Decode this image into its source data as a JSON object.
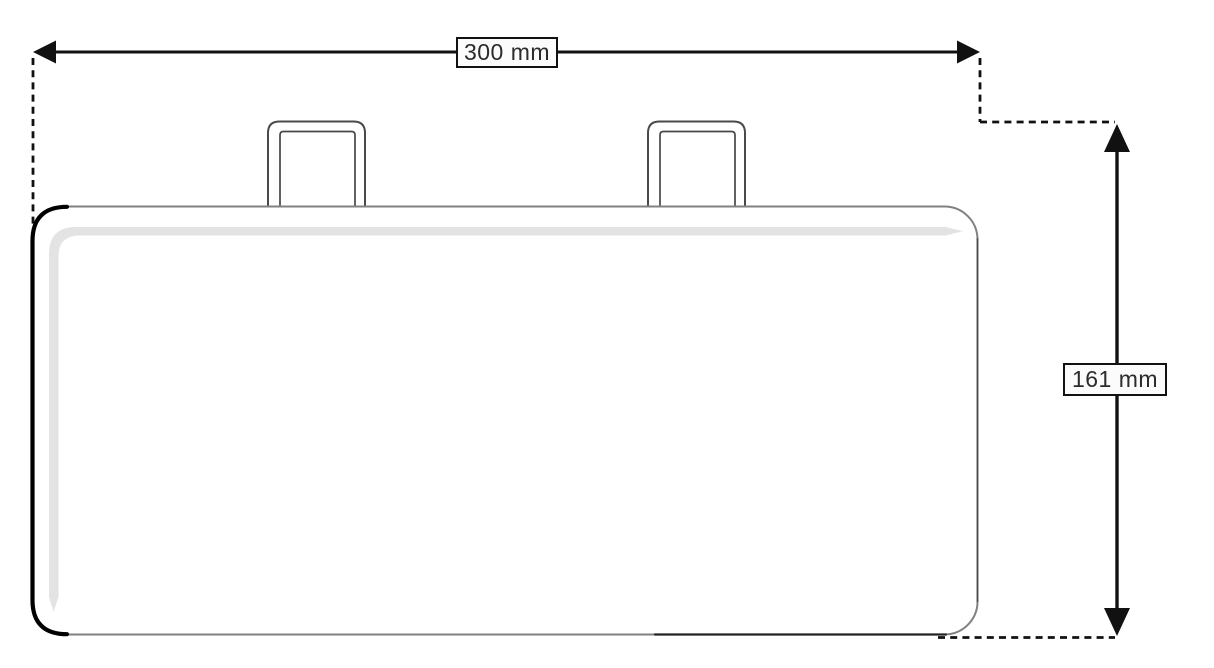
{
  "page": {
    "background_color": "#ffffff"
  },
  "drawing": {
    "kind": "technical-dimension-drawing",
    "labels": {
      "width_dimension": "300 mm",
      "height_dimension": "161 mm"
    },
    "dimensions": {
      "width": {
        "value": 300,
        "unit": "mm",
        "orientation": "horizontal"
      },
      "height": {
        "value": 161,
        "unit": "mm",
        "orientation": "vertical"
      }
    },
    "colors": {
      "dimension_lines": "#111111",
      "arrowheads": "#111111",
      "label_border": "#111111",
      "label_background": "#fbfbfb",
      "label_text": "#2b2b2b",
      "outline_thick_left": "#000000",
      "outline_light": "#818181",
      "outline_right": "#4b4b4b",
      "outline_bottom_dark": "#222222",
      "tab_outline": "#4a4a4a",
      "highlight_band": "#e3e3e3",
      "object_fill": "#ffffff"
    }
  }
}
